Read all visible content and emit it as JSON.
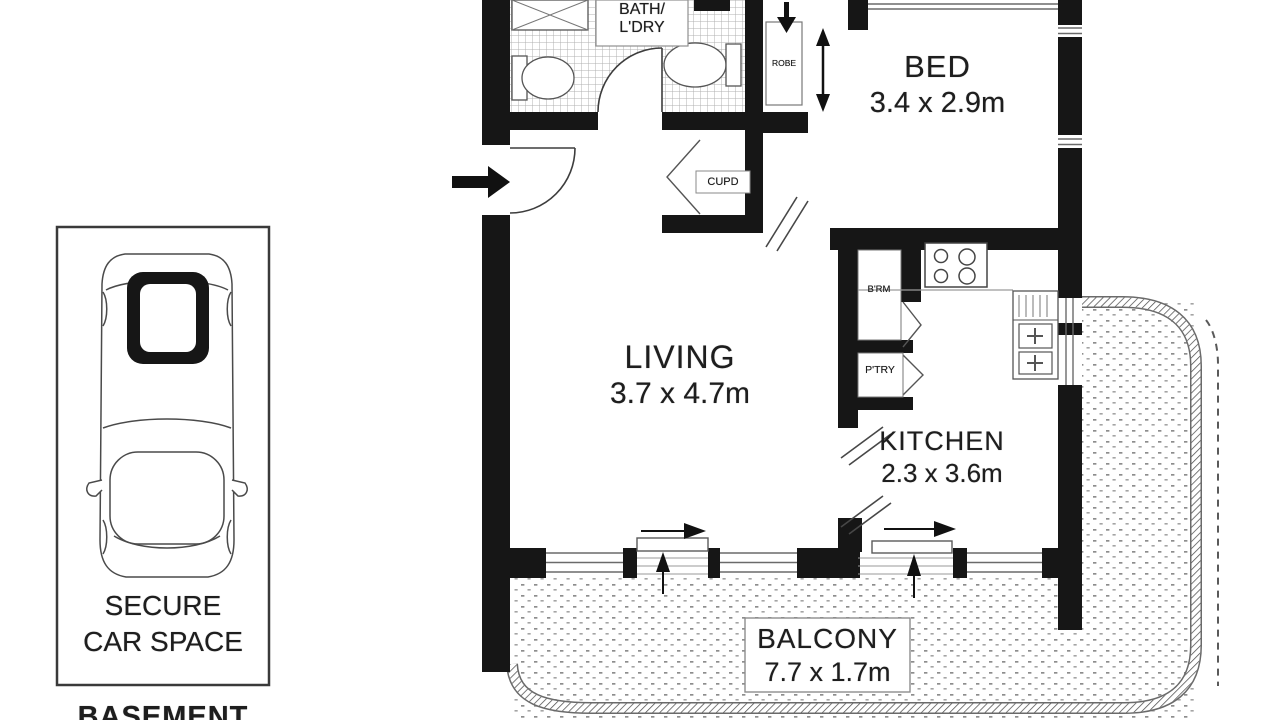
{
  "floor_plan": {
    "bed": {
      "name": "BED",
      "dims": "3.4 x 2.9m"
    },
    "living": {
      "name": "LIVING",
      "dims": "3.7 x 4.7m"
    },
    "kitchen": {
      "name": "KITCHEN",
      "dims": "2.3 x 3.6m"
    },
    "balcony": {
      "name": "BALCONY",
      "dims": "7.7 x 1.7m"
    },
    "bath": {
      "line1": "BATH/",
      "line2": "L'DRY"
    },
    "cupboard": "CUPD",
    "robe": "ROBE",
    "broom_cupboard": "B'RM",
    "pantry": "P'TRY"
  },
  "parking": {
    "line1": "SECURE",
    "line2": "CAR SPACE",
    "level": "BASEMENT"
  },
  "colors": {
    "wall": "#161616",
    "line": "#555555",
    "light_line": "#9a9a9a",
    "background": "#ffffff"
  }
}
